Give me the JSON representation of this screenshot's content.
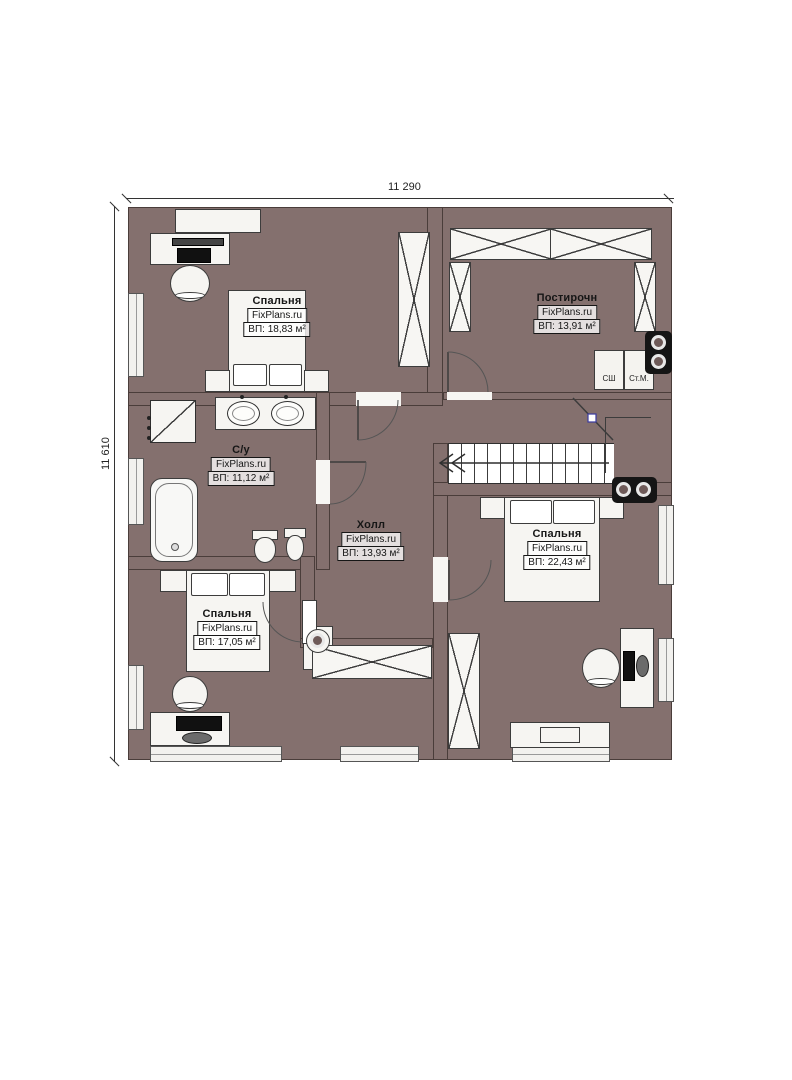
{
  "plan": {
    "dimensions": {
      "width_label": "11 290",
      "height_label": "11 610"
    },
    "branding": "FixPlans.ru",
    "rooms": [
      {
        "name": "Спальня",
        "brand": "FixPlans.ru",
        "area": "ВП: 18,83 м²"
      },
      {
        "name": "Постирочн",
        "brand": "FixPlans.ru",
        "area": "ВП: 13,91 м²"
      },
      {
        "name": "С/у",
        "brand": "FixPlans.ru",
        "area": "ВП: 11,12 м²"
      },
      {
        "name": "Холл",
        "brand": "FixPlans.ru",
        "area": "ВП: 13,93 м²"
      },
      {
        "name": "Спальня",
        "brand": "FixPlans.ru",
        "area": "ВП: 22,43 м²"
      },
      {
        "name": "Спальня",
        "brand": "FixPlans.ru",
        "area": "ВП: 17,05 м²"
      }
    ],
    "appliances": {
      "drying_cabinet": "СШ",
      "washing_machine": "Ст.М."
    },
    "colors": {
      "background": "#ffffff",
      "wall": "#84706e",
      "bedroom_floor": "#8d7b5e",
      "wet_room_tile": "#b9d3ee",
      "hall_tile": "#c9b388"
    }
  }
}
